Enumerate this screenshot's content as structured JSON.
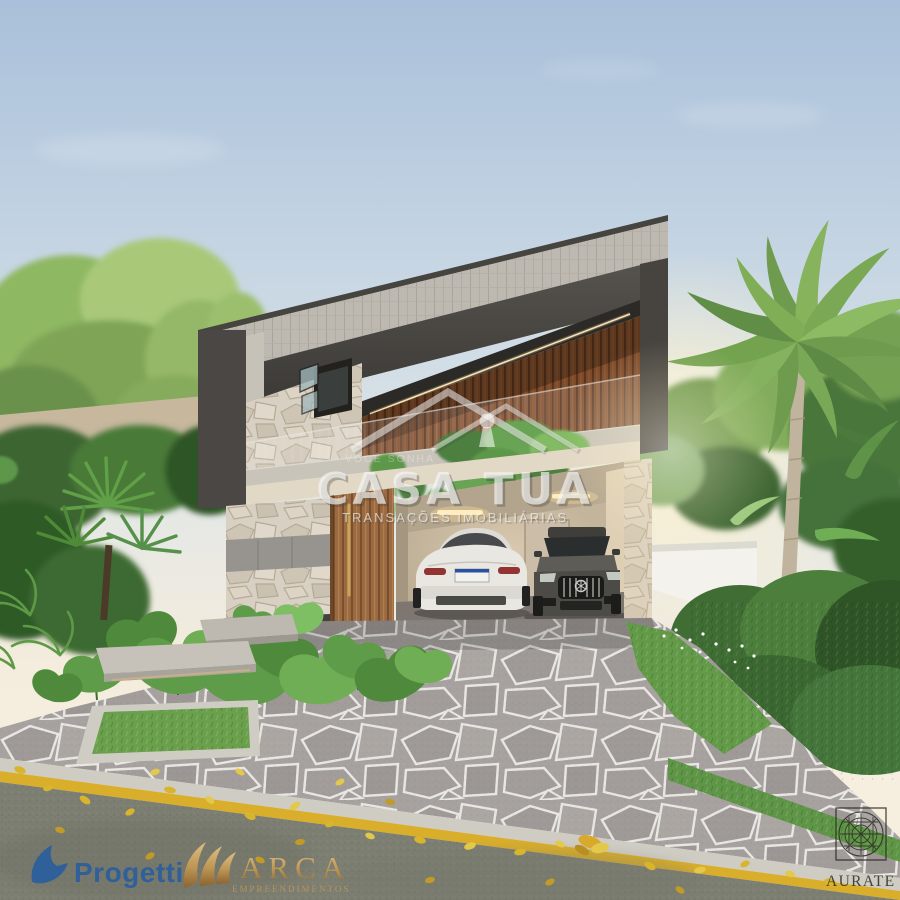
{
  "watermark": {
    "tagline": "VOCÊ SONHA",
    "brand": "CASA TUA",
    "subtitle": "TRANSAÇÕES IMOBILIÁRIAS",
    "icon": "roof-keyhole-icon",
    "text_color": "#ffffff"
  },
  "footer_logos": {
    "progetti": {
      "label": "Progetti",
      "icon": "bird-sail-icon",
      "color": "#2a5f9d"
    },
    "arca": {
      "label": "ARCA",
      "sublabel": "EMPREENDIMENTOS",
      "icon": "golden-sails-icon",
      "color": "#c89a52"
    },
    "aurate": {
      "label": "AURATE",
      "icon": "mandala-lattice-icon",
      "color": "#2b2b24"
    }
  },
  "scene": {
    "palette": {
      "sky_top": "#a9c0da",
      "sky_horizon": "#f4ecdc",
      "charcoal_frame": "#4a4744",
      "wood_slats": "#7b4a2b",
      "stone_veneer": "#d8d0c2",
      "driveway_stone": "#a29d99",
      "asphalt": "#7d7f72",
      "curb_line_yellow": "#d9ae2b",
      "foliage_green": "#4f7f3b",
      "lawn_green": "#639a48"
    }
  }
}
